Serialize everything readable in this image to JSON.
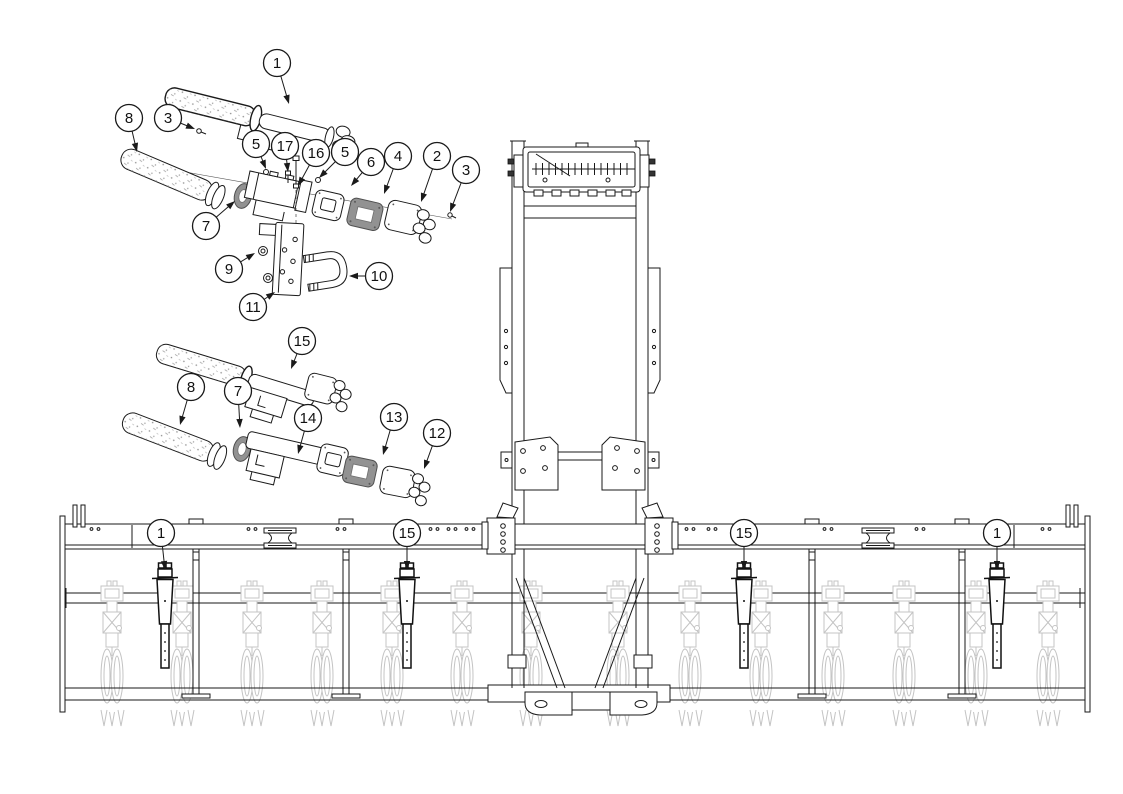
{
  "document": {
    "kind": "exploded-parts-diagram",
    "description": "Line-art exploded parts diagram with numbered callout balloons (parts 1-17) above a front elevation view of a toolbar implement with row units; callouts 1 and 15 mark installed assemblies on the toolbar."
  },
  "colors": {
    "line": "#1a1a1a",
    "light_gray_line": "#c4c4c4",
    "gasket_fill": "#929292",
    "background": "#ffffff"
  },
  "machine": {
    "row_unit_count": 14,
    "marker_count": 4,
    "stand_count": 4
  },
  "callouts": {
    "balloon_radius": 13.5,
    "items": [
      {
        "view": "top-exploded",
        "label": "1",
        "cx": 277,
        "cy": 63,
        "tip": [
          289,
          104
        ]
      },
      {
        "view": "top-exploded",
        "label": "8",
        "cx": 129,
        "cy": 118,
        "tip": [
          137,
          152
        ]
      },
      {
        "view": "top-exploded",
        "label": "3",
        "cx": 168,
        "cy": 118,
        "tip": [
          195,
          129
        ]
      },
      {
        "view": "top-exploded",
        "label": "5",
        "cx": 256,
        "cy": 144,
        "tip": [
          266,
          169
        ]
      },
      {
        "view": "top-exploded",
        "label": "17",
        "cx": 285,
        "cy": 146,
        "tip": [
          288,
          172
        ]
      },
      {
        "view": "top-exploded",
        "label": "16",
        "cx": 316,
        "cy": 153,
        "tip": [
          298,
          186
        ]
      },
      {
        "view": "top-exploded",
        "label": "5",
        "cx": 345,
        "cy": 152,
        "tip": [
          319,
          178
        ]
      },
      {
        "view": "top-exploded",
        "label": "6",
        "cx": 371,
        "cy": 162,
        "tip": [
          351,
          186
        ]
      },
      {
        "view": "top-exploded",
        "label": "4",
        "cx": 398,
        "cy": 156,
        "tip": [
          384,
          194
        ]
      },
      {
        "view": "top-exploded",
        "label": "2",
        "cx": 437,
        "cy": 156,
        "tip": [
          421,
          202
        ]
      },
      {
        "view": "top-exploded",
        "label": "3",
        "cx": 466,
        "cy": 170,
        "tip": [
          450,
          212
        ]
      },
      {
        "view": "top-exploded",
        "label": "7",
        "cx": 206,
        "cy": 226,
        "tip": [
          235,
          201
        ]
      },
      {
        "view": "top-exploded",
        "label": "9",
        "cx": 229,
        "cy": 269,
        "tip": [
          255,
          253
        ]
      },
      {
        "view": "top-exploded",
        "label": "10",
        "cx": 379,
        "cy": 276,
        "tip": [
          349,
          276
        ]
      },
      {
        "view": "top-exploded",
        "label": "11",
        "cx": 253,
        "cy": 307,
        "tip": [
          275,
          292
        ]
      },
      {
        "view": "middle-exploded",
        "label": "15",
        "cx": 302,
        "cy": 341,
        "tip": [
          291,
          369
        ]
      },
      {
        "view": "middle-exploded",
        "label": "8",
        "cx": 191,
        "cy": 387,
        "tip": [
          180,
          425
        ]
      },
      {
        "view": "middle-exploded",
        "label": "7",
        "cx": 238,
        "cy": 391,
        "tip": [
          240,
          428
        ]
      },
      {
        "view": "middle-exploded",
        "label": "14",
        "cx": 308,
        "cy": 418,
        "tip": [
          298,
          454
        ]
      },
      {
        "view": "middle-exploded",
        "label": "13",
        "cx": 394,
        "cy": 417,
        "tip": [
          383,
          455
        ]
      },
      {
        "view": "middle-exploded",
        "label": "12",
        "cx": 437,
        "cy": 433,
        "tip": [
          424,
          469
        ]
      },
      {
        "view": "machine",
        "label": "1",
        "cx": 161,
        "cy": 533,
        "tip": [
          165,
          570
        ]
      },
      {
        "view": "machine",
        "label": "15",
        "cx": 407,
        "cy": 533,
        "tip": [
          407,
          570
        ]
      },
      {
        "view": "machine",
        "label": "15",
        "cx": 744,
        "cy": 533,
        "tip": [
          744,
          570
        ]
      },
      {
        "view": "machine",
        "label": "1",
        "cx": 997,
        "cy": 533,
        "tip": [
          997,
          570
        ]
      }
    ]
  }
}
